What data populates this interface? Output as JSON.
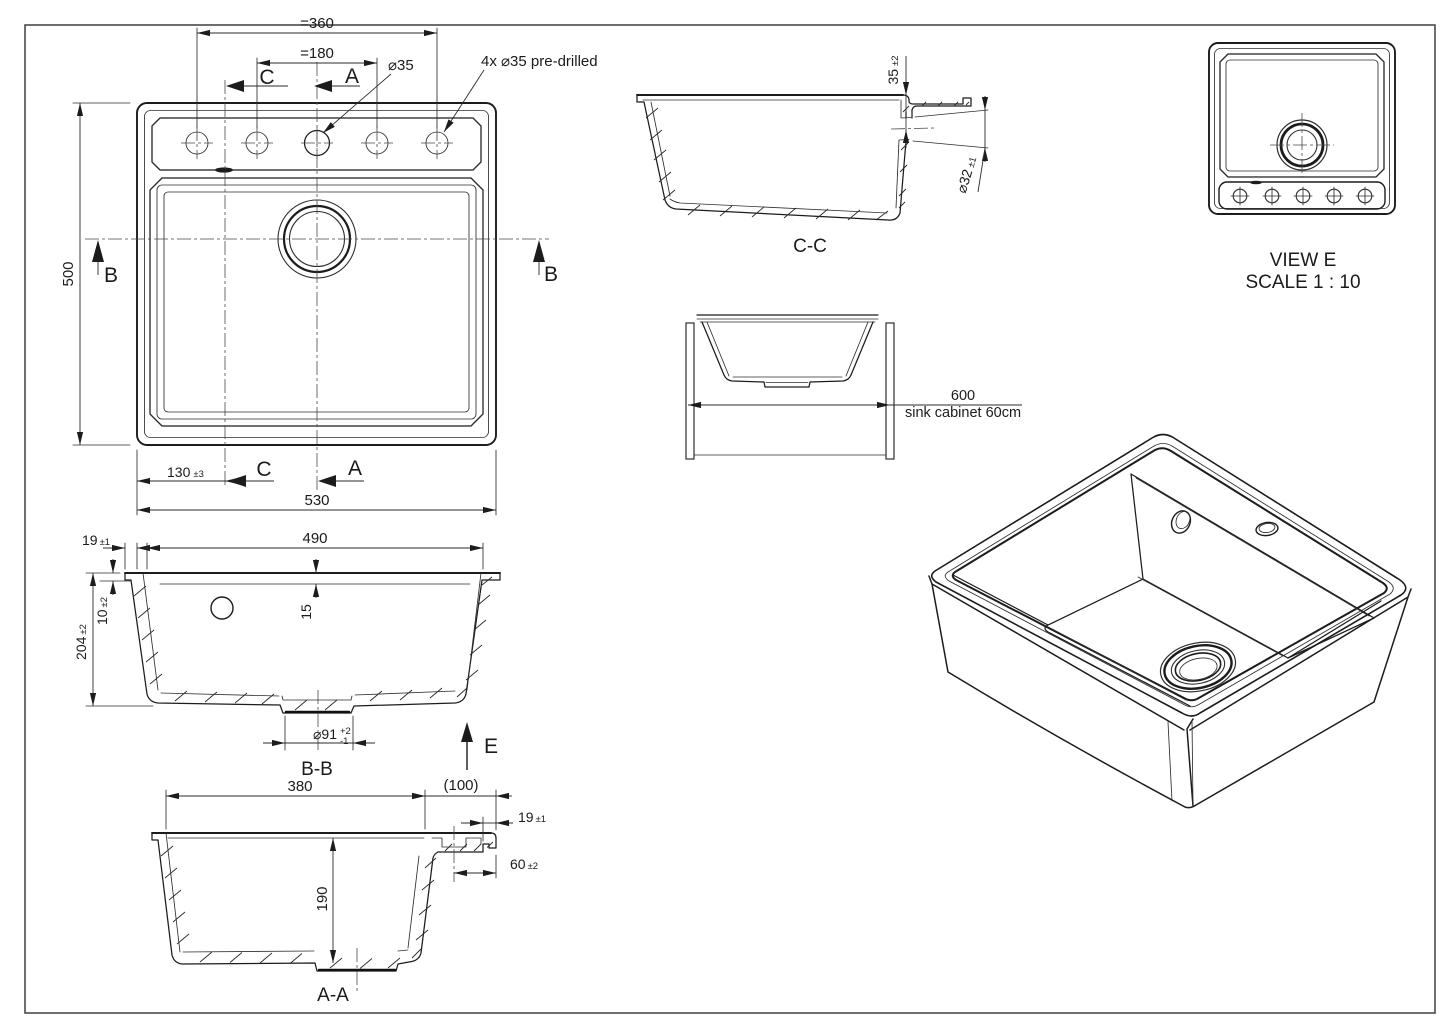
{
  "views": {
    "plan": {
      "dim_360": "=360",
      "dim_180": "=180",
      "label_c": "C",
      "label_a": "A",
      "label_b": "B",
      "dia35": "⌀35",
      "note_predrilled": "4x ⌀35 pre-drilled",
      "dim_500": "500",
      "dim_130": "130",
      "dim_130_tol": "±3",
      "dim_530": "530"
    },
    "section_cc": {
      "title": "C-C",
      "dim_35": "35",
      "dim_35_tol": "±2",
      "dia32": "⌀32",
      "dia32_tol": "±1"
    },
    "cabinet": {
      "dim_600": "600",
      "caption": "sink cabinet 60cm"
    },
    "view_e": {
      "title": "VIEW E",
      "scale": "SCALE 1 : 10"
    },
    "section_bb": {
      "title": "B-B",
      "dim_19": "19",
      "dim_19_tol": "±1",
      "dim_490": "490",
      "dim_10": "10",
      "dim_10_tol": "±2",
      "dim_204": "204",
      "dim_204_tol": "±2",
      "dim_15": "15",
      "dia91": "⌀91",
      "dia91_plus": "+2",
      "dia91_minus": "-1",
      "label_e": "E"
    },
    "section_aa": {
      "title": "A-A",
      "dim_380": "380",
      "dim_100": "(100)",
      "dim_19": "19",
      "dim_19_tol": "±1",
      "dim_60": "60",
      "dim_60_tol": "±2",
      "dim_190": "190"
    }
  }
}
